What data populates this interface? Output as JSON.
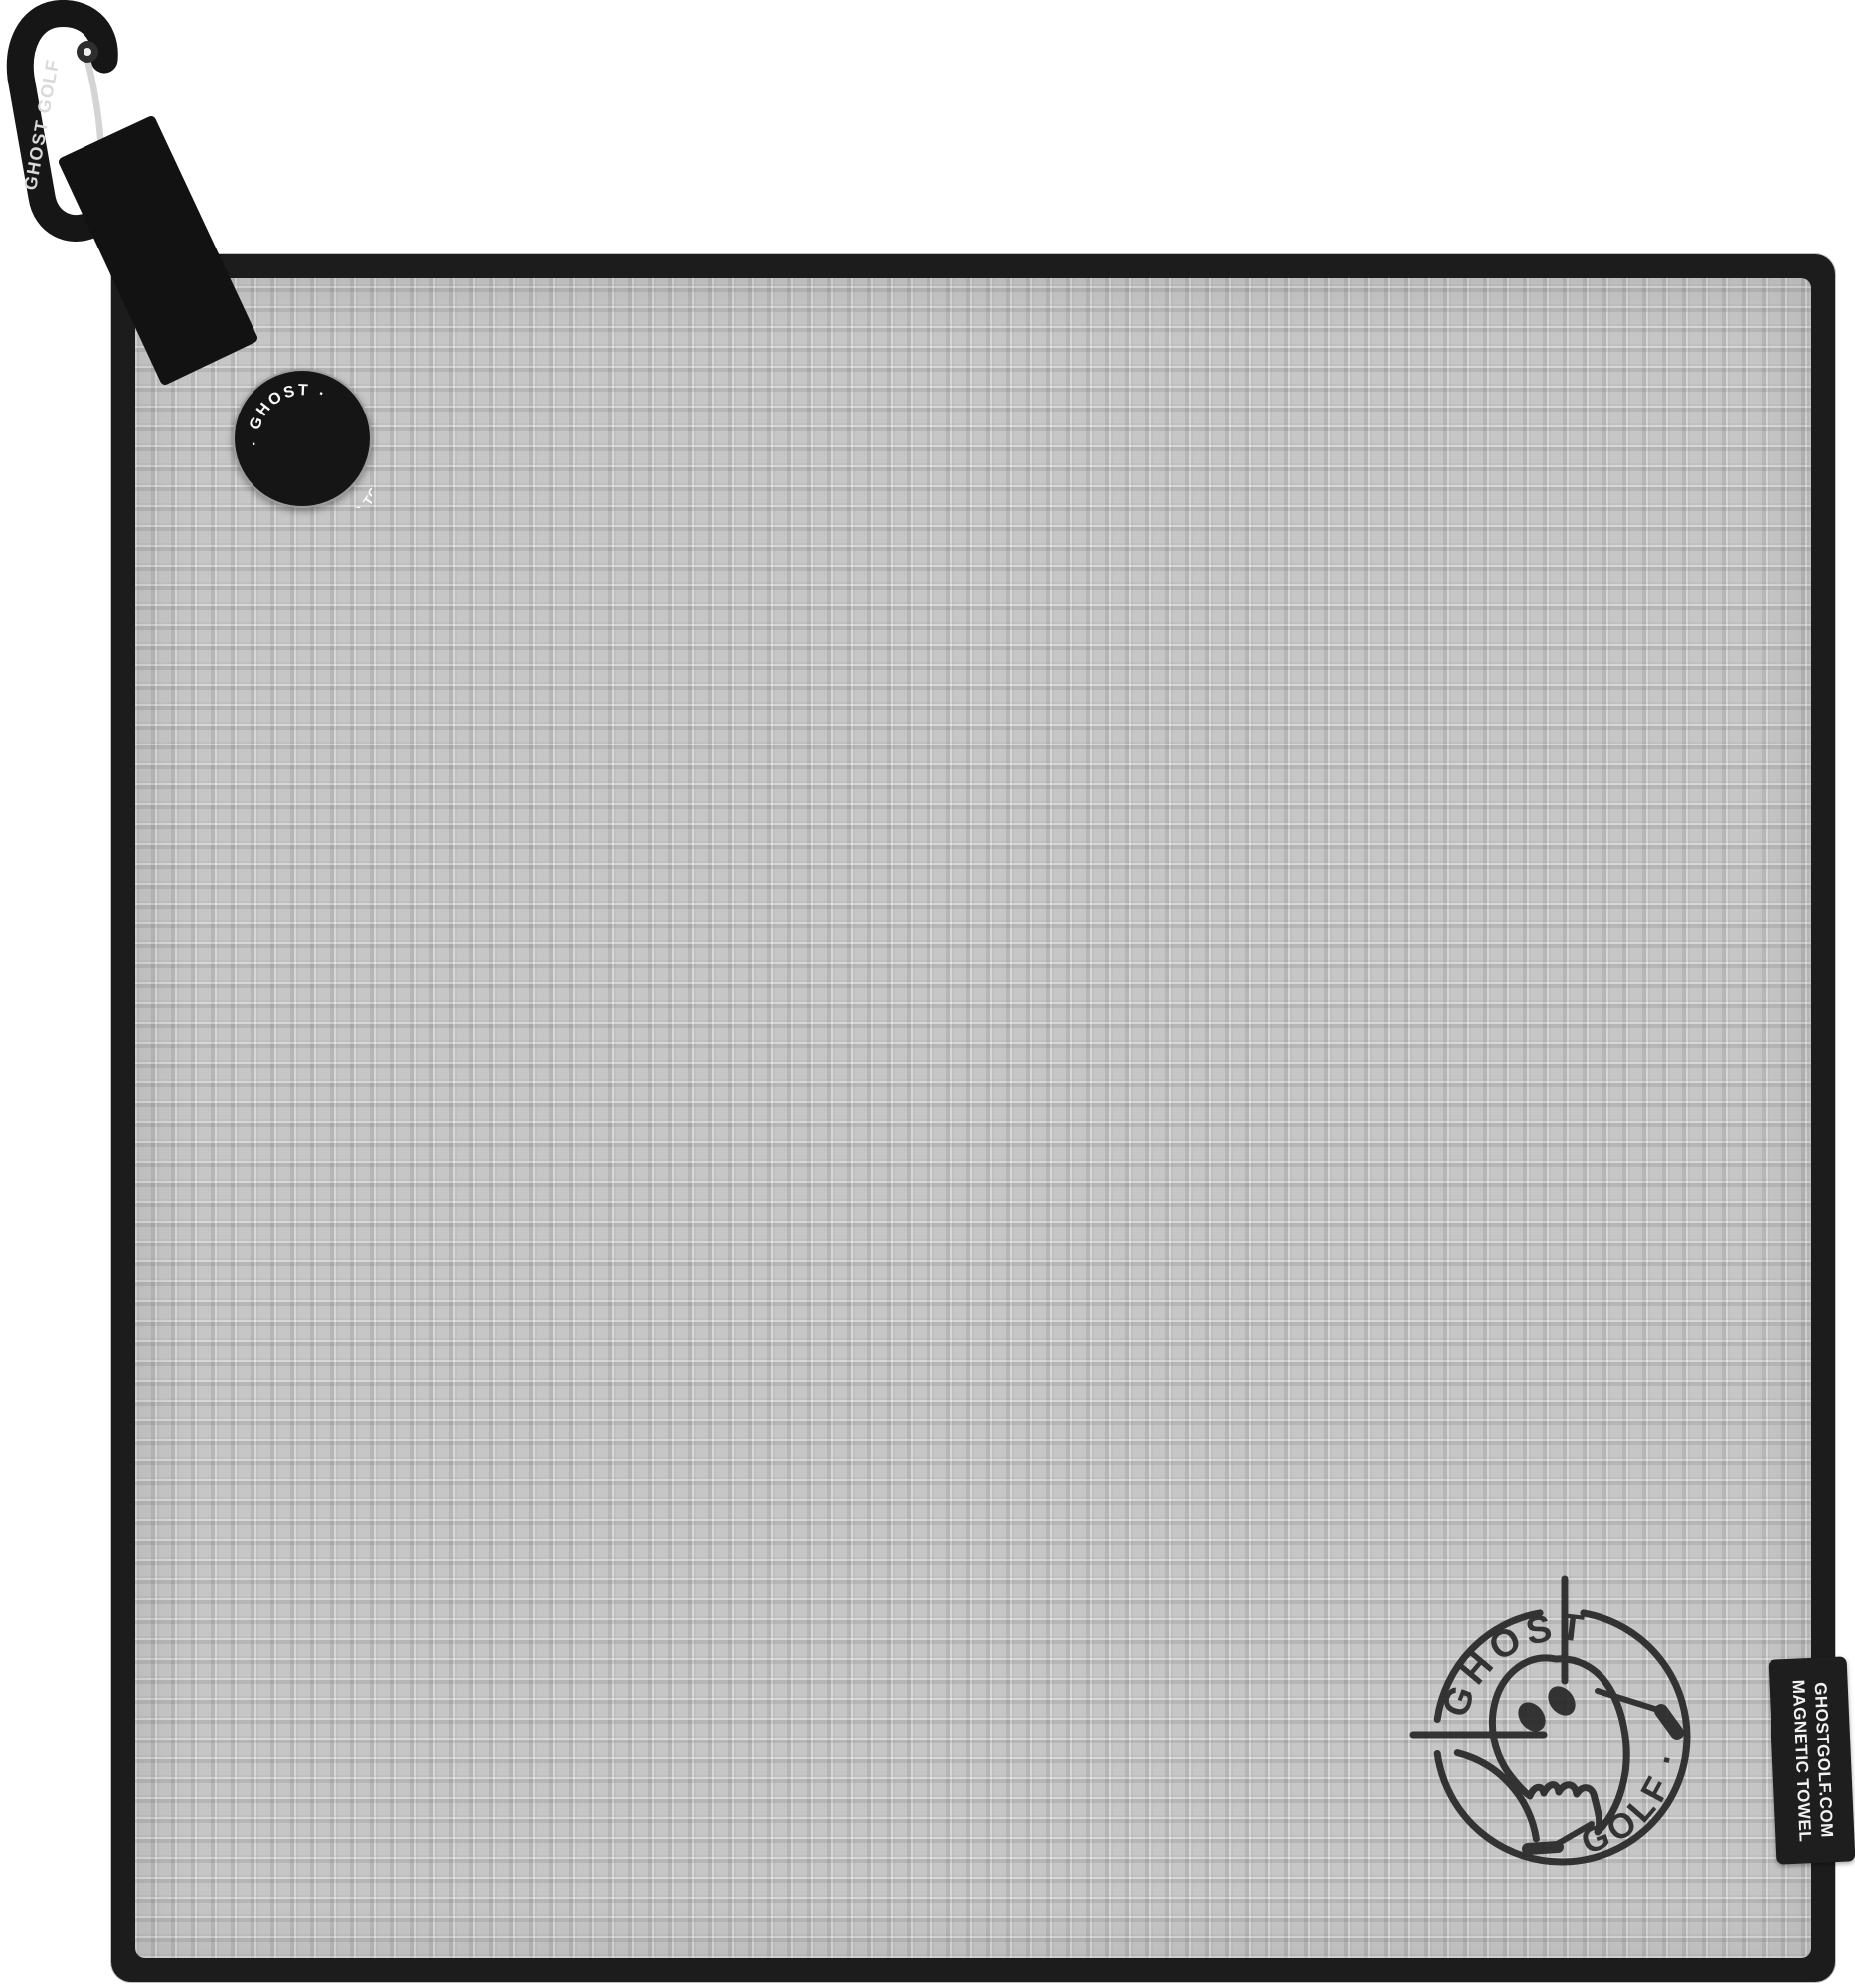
{
  "product_photo": {
    "description": "Gray waffle-weave magnetic golf towel with black trim, black carabiner clip, circular logo patch, stamped ghost logo and woven side tag",
    "colors": {
      "background": "#ffffff",
      "towel_fabric": "#c6c6c6",
      "towel_trim": "#1c1c1c",
      "patch_background": "#151515",
      "stamp_ink": "#242424",
      "tag_background": "#1e1e1e",
      "label_text": "#f2f2f2"
    }
  },
  "carabiner": {
    "label": "GHOST GOLF"
  },
  "corner_patch": {
    "arc_top": "· GHOST ·",
    "arc_bottom": "MAGNETIC TOWEL"
  },
  "stamp_logo": {
    "arc_top": "GHOST",
    "arc_bottom": "· GOLF ·"
  },
  "side_tag": {
    "line1": "GHOSTGOLF.COM",
    "line2": "MAGNETIC TOWEL"
  }
}
